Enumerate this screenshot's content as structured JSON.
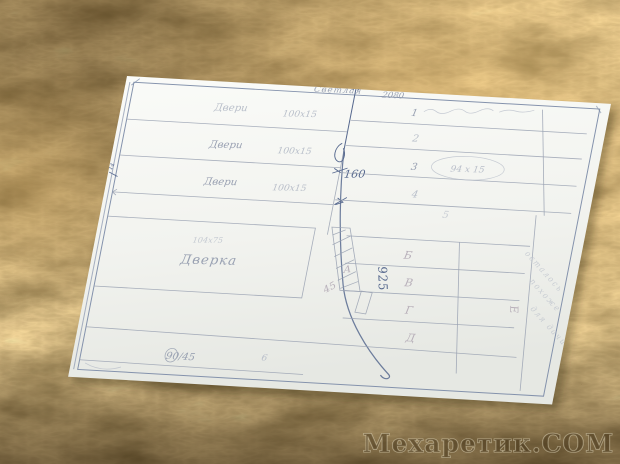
{
  "colors": {
    "fur": "#8a6a35",
    "fur-dark": "#4a3210",
    "fur-light": "#d2a55c",
    "paper": "#f4f5f1",
    "ink": "#56688e",
    "ink-border": "#8492ac",
    "pencil": "#99a1b2",
    "faint": "#b9bfca",
    "letter": "#b3aab5",
    "wm-fill": "#45341a",
    "wm-stroke": "#efe6c9"
  },
  "header": {
    "title": "Светлая",
    "dimension": "2080"
  },
  "left_table": {
    "rows": [
      {
        "label": "Двери",
        "size": "100х15"
      },
      {
        "label": "Двери",
        "size": "100х15"
      },
      {
        "label": "Двери",
        "size": "100х15"
      }
    ]
  },
  "right_table": {
    "row_numbers": [
      "1",
      "2",
      "3",
      "4",
      "5"
    ],
    "oval_label": "94 х 15"
  },
  "dimensions": {
    "vertical": "160",
    "long": "925",
    "edge_tick": "14"
  },
  "door_box": {
    "note": "104х75",
    "label": "Дверка"
  },
  "bottom_row": {
    "left_value": "90/45",
    "right_value": "6"
  },
  "letter_rows": {
    "letters": [
      "Б",
      "В",
      "Г",
      "Д"
    ],
    "side_letter": "Е",
    "corner_letter": "А",
    "diag_value": "45"
  },
  "side_note": {
    "line1": "осталось",
    "line2": "похоже",
    "line3": "для дачи"
  },
  "watermark": {
    "text": "Мехаретик.СОМ"
  }
}
